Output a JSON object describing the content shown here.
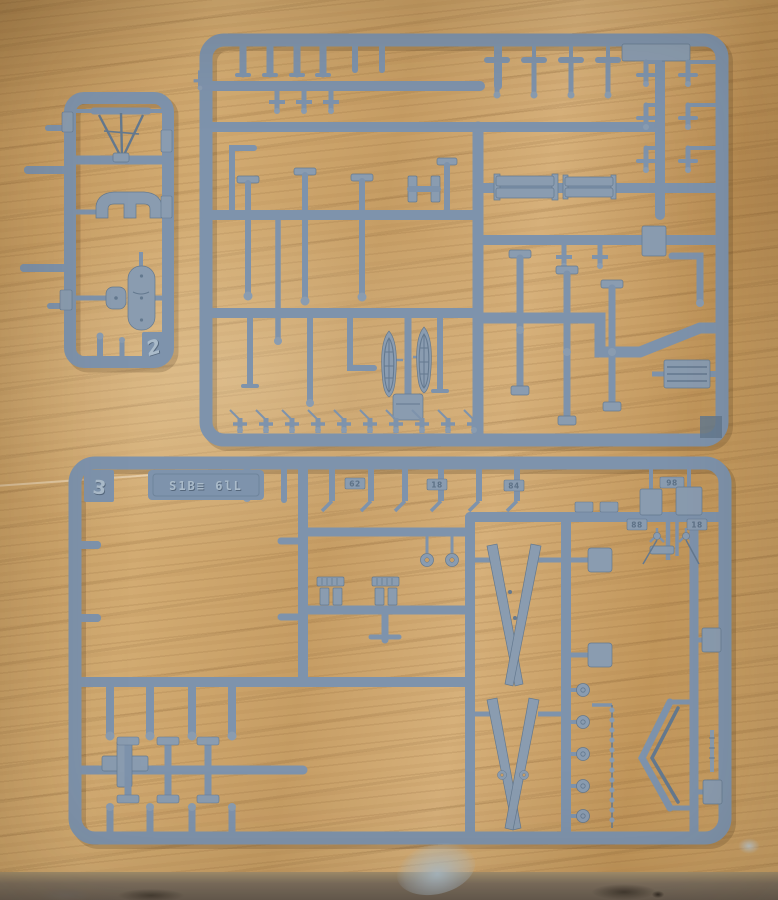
{
  "scene": {
    "type": "photograph",
    "subject": "Three grey-blue plastic model kit sprues (injection-moulded runners holding unassembled warship model parts) lying on a light oak wooden table with a scuffed, paint-stained front edge",
    "sprue_count": "3"
  },
  "colors": {
    "plastic_base": "#7E93AC",
    "plastic_light": "#9AACBF",
    "plastic_dark": "#64798F",
    "plastic_part": "#8A9CB0",
    "wood_light": "#D8B27C",
    "wood_mid": "#C79E66",
    "wood_dark": "#A87E4B",
    "table_edge": "#6F6358",
    "paint_smudge_blue": "#AFC2D2"
  },
  "sprues": {
    "left": {
      "label": "small narrow runner",
      "embossed_number": "2"
    },
    "top": {
      "label": "large upper runner"
    },
    "bottom": {
      "label": "large lower runner",
      "embossed_number": "3",
      "plate_text": "S1B≡ 6lL"
    }
  },
  "tags": {
    "a": "62",
    "b": "18",
    "c": "84",
    "d": "98",
    "e": "88",
    "f": "18"
  }
}
